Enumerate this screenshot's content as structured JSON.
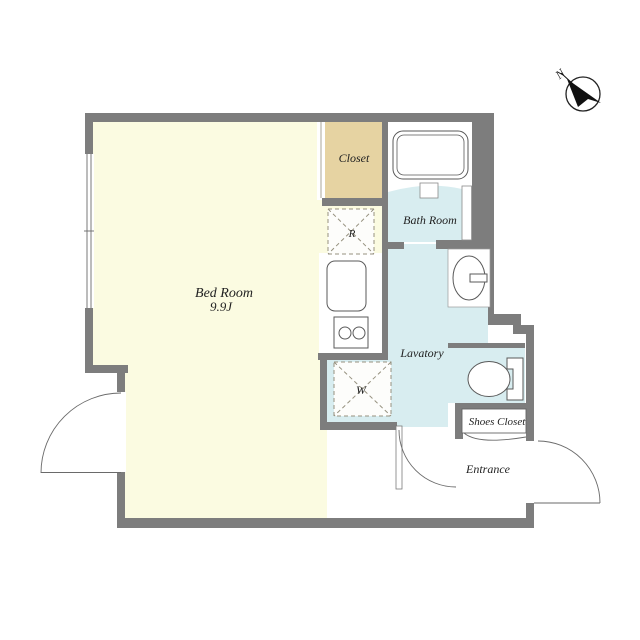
{
  "type": "floor_plan",
  "rooms": {
    "bedroom": {
      "name": "Bed Room",
      "size": "9.9J"
    },
    "closet": {
      "name": "Closet"
    },
    "bathroom": {
      "name": "Bath Room"
    },
    "lavatory": {
      "name": "Lavatory"
    },
    "shoes_closet": {
      "name": "Shoes Closet"
    },
    "entrance": {
      "name": "Entrance"
    }
  },
  "appliance_marks": {
    "refrigerator": "R",
    "washer": "W"
  },
  "compass": {
    "north_label": "N"
  },
  "colors": {
    "wall": "#7d7d7d",
    "bedroom_floor": "#fbfbe1",
    "closet_floor": "#e6d3a2",
    "wet_area_floor": "#d8edf0",
    "room_white": "#ffffff",
    "fixture_stroke": "#5a5a5a",
    "label_text": "#222222"
  }
}
